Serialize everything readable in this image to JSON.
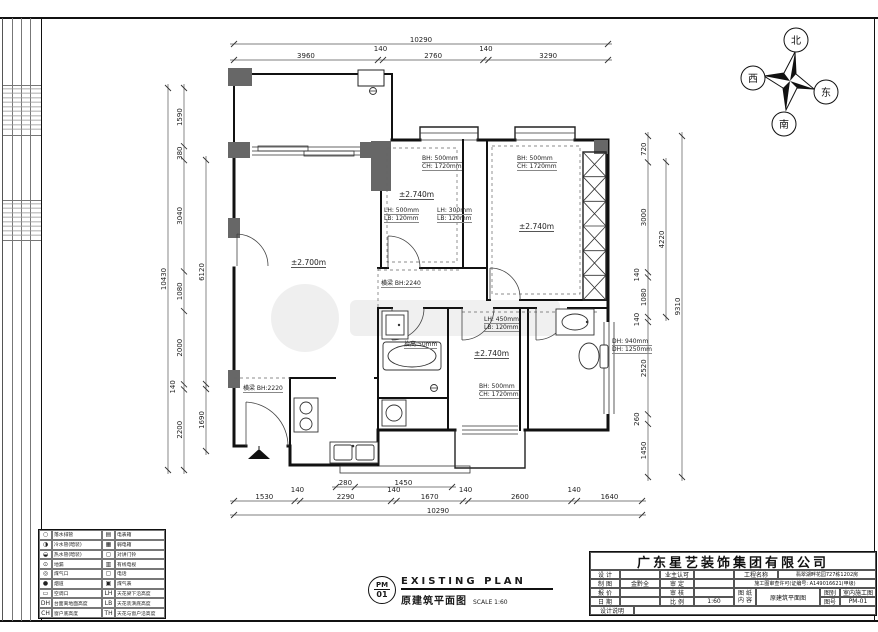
{
  "sheet": {
    "company": "广东星艺装饰集团有限公司",
    "title_block": {
      "left_rows": [
        {
          "a": "设 计",
          "b": "",
          "c": "业主认可",
          "d": ""
        },
        {
          "a": "制 图",
          "b": "金黔全",
          "c": "审 定",
          "d": ""
        },
        {
          "a": "报 价",
          "b": "",
          "c": "审 核",
          "d": ""
        },
        {
          "a": "日 期",
          "b": "",
          "c": "比 例",
          "d": "1:60"
        }
      ],
      "note_label": "设计说明",
      "project_label": "工程名称",
      "project_value": "翡翠湖畔花园727栋1202房",
      "permit": "施工图审查许可(证编号: A149016621(甲级)",
      "sheet_label_1": "图 纸",
      "sheet_label_2": "内 容",
      "sheet_value": "原建筑平面图",
      "type_label": "图别",
      "type_value": "室内施工图",
      "no_label": "图号",
      "no_value": "PM-01"
    },
    "stamp": {
      "code_top": "PM",
      "code_bottom": "01",
      "title_en": "EXISTING PLAN",
      "title_cn": "原建筑平面图",
      "scale": "SCALE 1:60"
    },
    "compass": {
      "n": "北",
      "e": "东",
      "s": "南",
      "w": "西"
    },
    "legend": {
      "rows": [
        {
          "li": "○",
          "ll": "落水排管",
          "ri": "▤",
          "rl": "电表箱"
        },
        {
          "li": "◑",
          "ll": "冷水管(暗装)",
          "ri": "▦",
          "rl": "弱电箱"
        },
        {
          "li": "◒",
          "ll": "热水管(暗装)",
          "ri": "◻",
          "rl": "对讲门铃"
        },
        {
          "li": "⊙",
          "ll": "地漏",
          "ri": "▥",
          "rl": "有线电视"
        },
        {
          "li": "◎",
          "ll": "煤气口",
          "ri": "▢",
          "rl": "电话"
        },
        {
          "li": "●",
          "ll": "烟道",
          "ri": "▣",
          "rl": "煤气表"
        },
        {
          "li": "▭",
          "ll": "空调口",
          "ri": "LH",
          "rl": "天花梁下沿高度"
        },
        {
          "li": "DH",
          "ll": "台面离地面高度",
          "ri": "LB",
          "rl": "天花装潢底高度"
        },
        {
          "li": "CH",
          "ll": "窗户底高度",
          "ri": "TH",
          "rl": "天花与窗户沿高度"
        }
      ]
    }
  },
  "plan": {
    "levels": [
      "±2.700m",
      "±2.740m",
      "±2.740m",
      "±2.740m"
    ],
    "notes": [
      {
        "l1": "BH: 500mm",
        "l2": "CH: 1720mm"
      },
      {
        "l1": "BH: 500mm",
        "l2": "CH: 1720mm"
      },
      {
        "l1": "LH: 500mm",
        "l2": "LB: 120mm"
      },
      {
        "l1": "LH: 300mm",
        "l2": "LB: 120mm"
      },
      {
        "l1": "LH: 450mm",
        "l2": "LB: 120mm"
      },
      {
        "l1": "BH: 500mm",
        "l2": "CH: 1720mm"
      },
      {
        "l1": "DH: 940mm",
        "l2": "DH: 1250mm"
      },
      {
        "l1": "横梁 BH:2240",
        "l2": ""
      },
      {
        "l1": "横梁 BH:2220",
        "l2": ""
      },
      {
        "l1": "抬高:50mm",
        "l2": ""
      }
    ],
    "dims": {
      "top": {
        "total": "10290",
        "segments": [
          "3960",
          "140",
          "2760",
          "140",
          "3290"
        ]
      },
      "bottom": {
        "total": "10290",
        "segments": [
          "1530",
          "140",
          "2290",
          "140",
          "1670",
          "140",
          "2600",
          "140",
          "1640"
        ],
        "sub": [
          "280",
          "1450"
        ]
      },
      "left": {
        "total": "10430",
        "segments": [
          "1590",
          "380",
          "3040",
          "1080",
          "2000",
          "140",
          "2200"
        ],
        "inner": [
          "6120",
          "1690"
        ]
      },
      "right": {
        "total": "9310",
        "segments": [
          "720",
          "3000",
          "140",
          "1080",
          "140",
          "2520",
          "260",
          "1450"
        ],
        "inner": [
          "4220"
        ]
      }
    }
  }
}
